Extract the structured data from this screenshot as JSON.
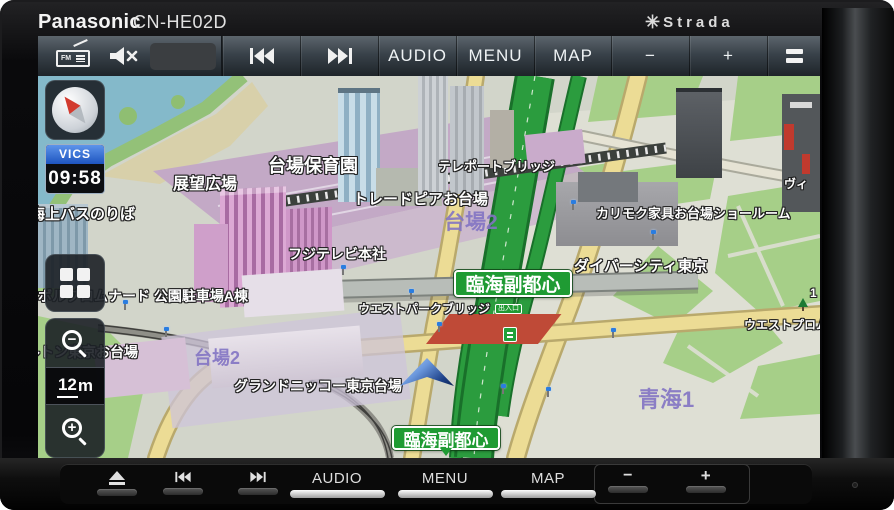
{
  "device": {
    "brand": "Panasonic",
    "model": "CN-HE02D",
    "logo_star": "✳",
    "logo": "Strada"
  },
  "screen_top_bar": {
    "fm_label": "FM",
    "buttons": [
      {
        "name": "prev-track",
        "icon": "prev-track-icon"
      },
      {
        "name": "next-track",
        "icon": "next-track-icon"
      },
      {
        "name": "audio",
        "label": "AUDIO"
      },
      {
        "name": "menu",
        "label": "MENU"
      },
      {
        "name": "map",
        "label": "MAP"
      },
      {
        "name": "volume-down",
        "label": "−"
      },
      {
        "name": "volume-up",
        "label": "+"
      },
      {
        "name": "list",
        "icon": "list-icon"
      }
    ]
  },
  "left_panel": {
    "vics_label": "VICS",
    "clock": "09:58",
    "scale_value": "12",
    "scale_unit": "m"
  },
  "map": {
    "place_labels": [
      {
        "text": "台場保育園",
        "x": 230,
        "y": 76,
        "size": 18
      },
      {
        "text": "展望広場",
        "x": 135,
        "y": 94,
        "size": 16
      },
      {
        "text": "テレポートブリッジ",
        "x": 400,
        "y": 80,
        "size": 13
      },
      {
        "text": "トレードピアお台場",
        "x": 315,
        "y": 112,
        "size": 15
      },
      {
        "text": "カリモク家具お台場ショールーム",
        "x": 558,
        "y": 127,
        "size": 13
      },
      {
        "text": "海上バスのりば",
        "x": -8,
        "y": 127,
        "size": 15
      },
      {
        "text": "フジテレビ本社",
        "x": 250,
        "y": 168,
        "size": 14
      },
      {
        "text": "ダイバーシティ東京",
        "x": 536,
        "y": 179,
        "size": 15
      },
      {
        "text": "ウエストパークブリッジ",
        "x": 320,
        "y": 224,
        "size": 12
      },
      {
        "text": "ンボルプロムナード 公園駐車場A棟",
        "x": -14,
        "y": 210,
        "size": 14,
        "under": true
      },
      {
        "text": "ヒルトン東京お台場",
        "x": -26,
        "y": 266,
        "size": 14,
        "under": true
      },
      {
        "text": "グランドニッコー東京台場",
        "x": 196,
        "y": 300,
        "size": 14
      },
      {
        "text": "ウエストプロムナード",
        "x": 706,
        "y": 240,
        "size": 12
      },
      {
        "text": "ヴィ",
        "x": 746,
        "y": 99,
        "size": 12
      },
      {
        "text": "1",
        "x": 772,
        "y": 210,
        "size": 12
      }
    ],
    "area_labels": [
      {
        "text": "台場2",
        "x": 406,
        "y": 130,
        "size": 21
      },
      {
        "text": "台場2",
        "x": 156,
        "y": 268,
        "size": 18
      },
      {
        "text": "青海1",
        "x": 600,
        "y": 306,
        "size": 22
      }
    ],
    "badges": [
      {
        "text": "臨海副都心",
        "x": 416,
        "y": 194,
        "w": 118,
        "h": 27,
        "size": 19,
        "pointer": false
      },
      {
        "text": "臨海副都心",
        "x": 354,
        "y": 350,
        "w": 108,
        "h": 24,
        "size": 17,
        "pointer": true
      }
    ],
    "mini_badge": {
      "text": "出入口",
      "x": 457,
      "y": 228
    },
    "signals": [
      [
        84,
        224
      ],
      [
        125,
        251
      ],
      [
        302,
        189
      ],
      [
        370,
        213
      ],
      [
        398,
        246
      ],
      [
        462,
        308
      ],
      [
        507,
        311
      ],
      [
        572,
        252
      ],
      [
        532,
        124
      ],
      [
        612,
        154
      ]
    ],
    "colors": {
      "badge_green": "#1f9b33",
      "highway_green": "#2b9c3e",
      "road_yellow": "#ecdc95",
      "water_teal": "#84b9ca",
      "area_label_purple": "#8d7ecb",
      "vics_blue": "#1e55c0"
    }
  },
  "hardware_bar": {
    "buttons": [
      {
        "name": "eject",
        "icon": "eject-icon"
      },
      {
        "name": "prev-track",
        "icon": "prev-track-icon"
      },
      {
        "name": "next-track",
        "icon": "next-track-icon"
      },
      {
        "name": "audio",
        "label": "AUDIO"
      },
      {
        "name": "menu",
        "label": "MENU"
      },
      {
        "name": "map",
        "label": "MAP"
      },
      {
        "name": "volume-down",
        "label": "−"
      },
      {
        "name": "volume-up",
        "label": "+"
      }
    ]
  }
}
